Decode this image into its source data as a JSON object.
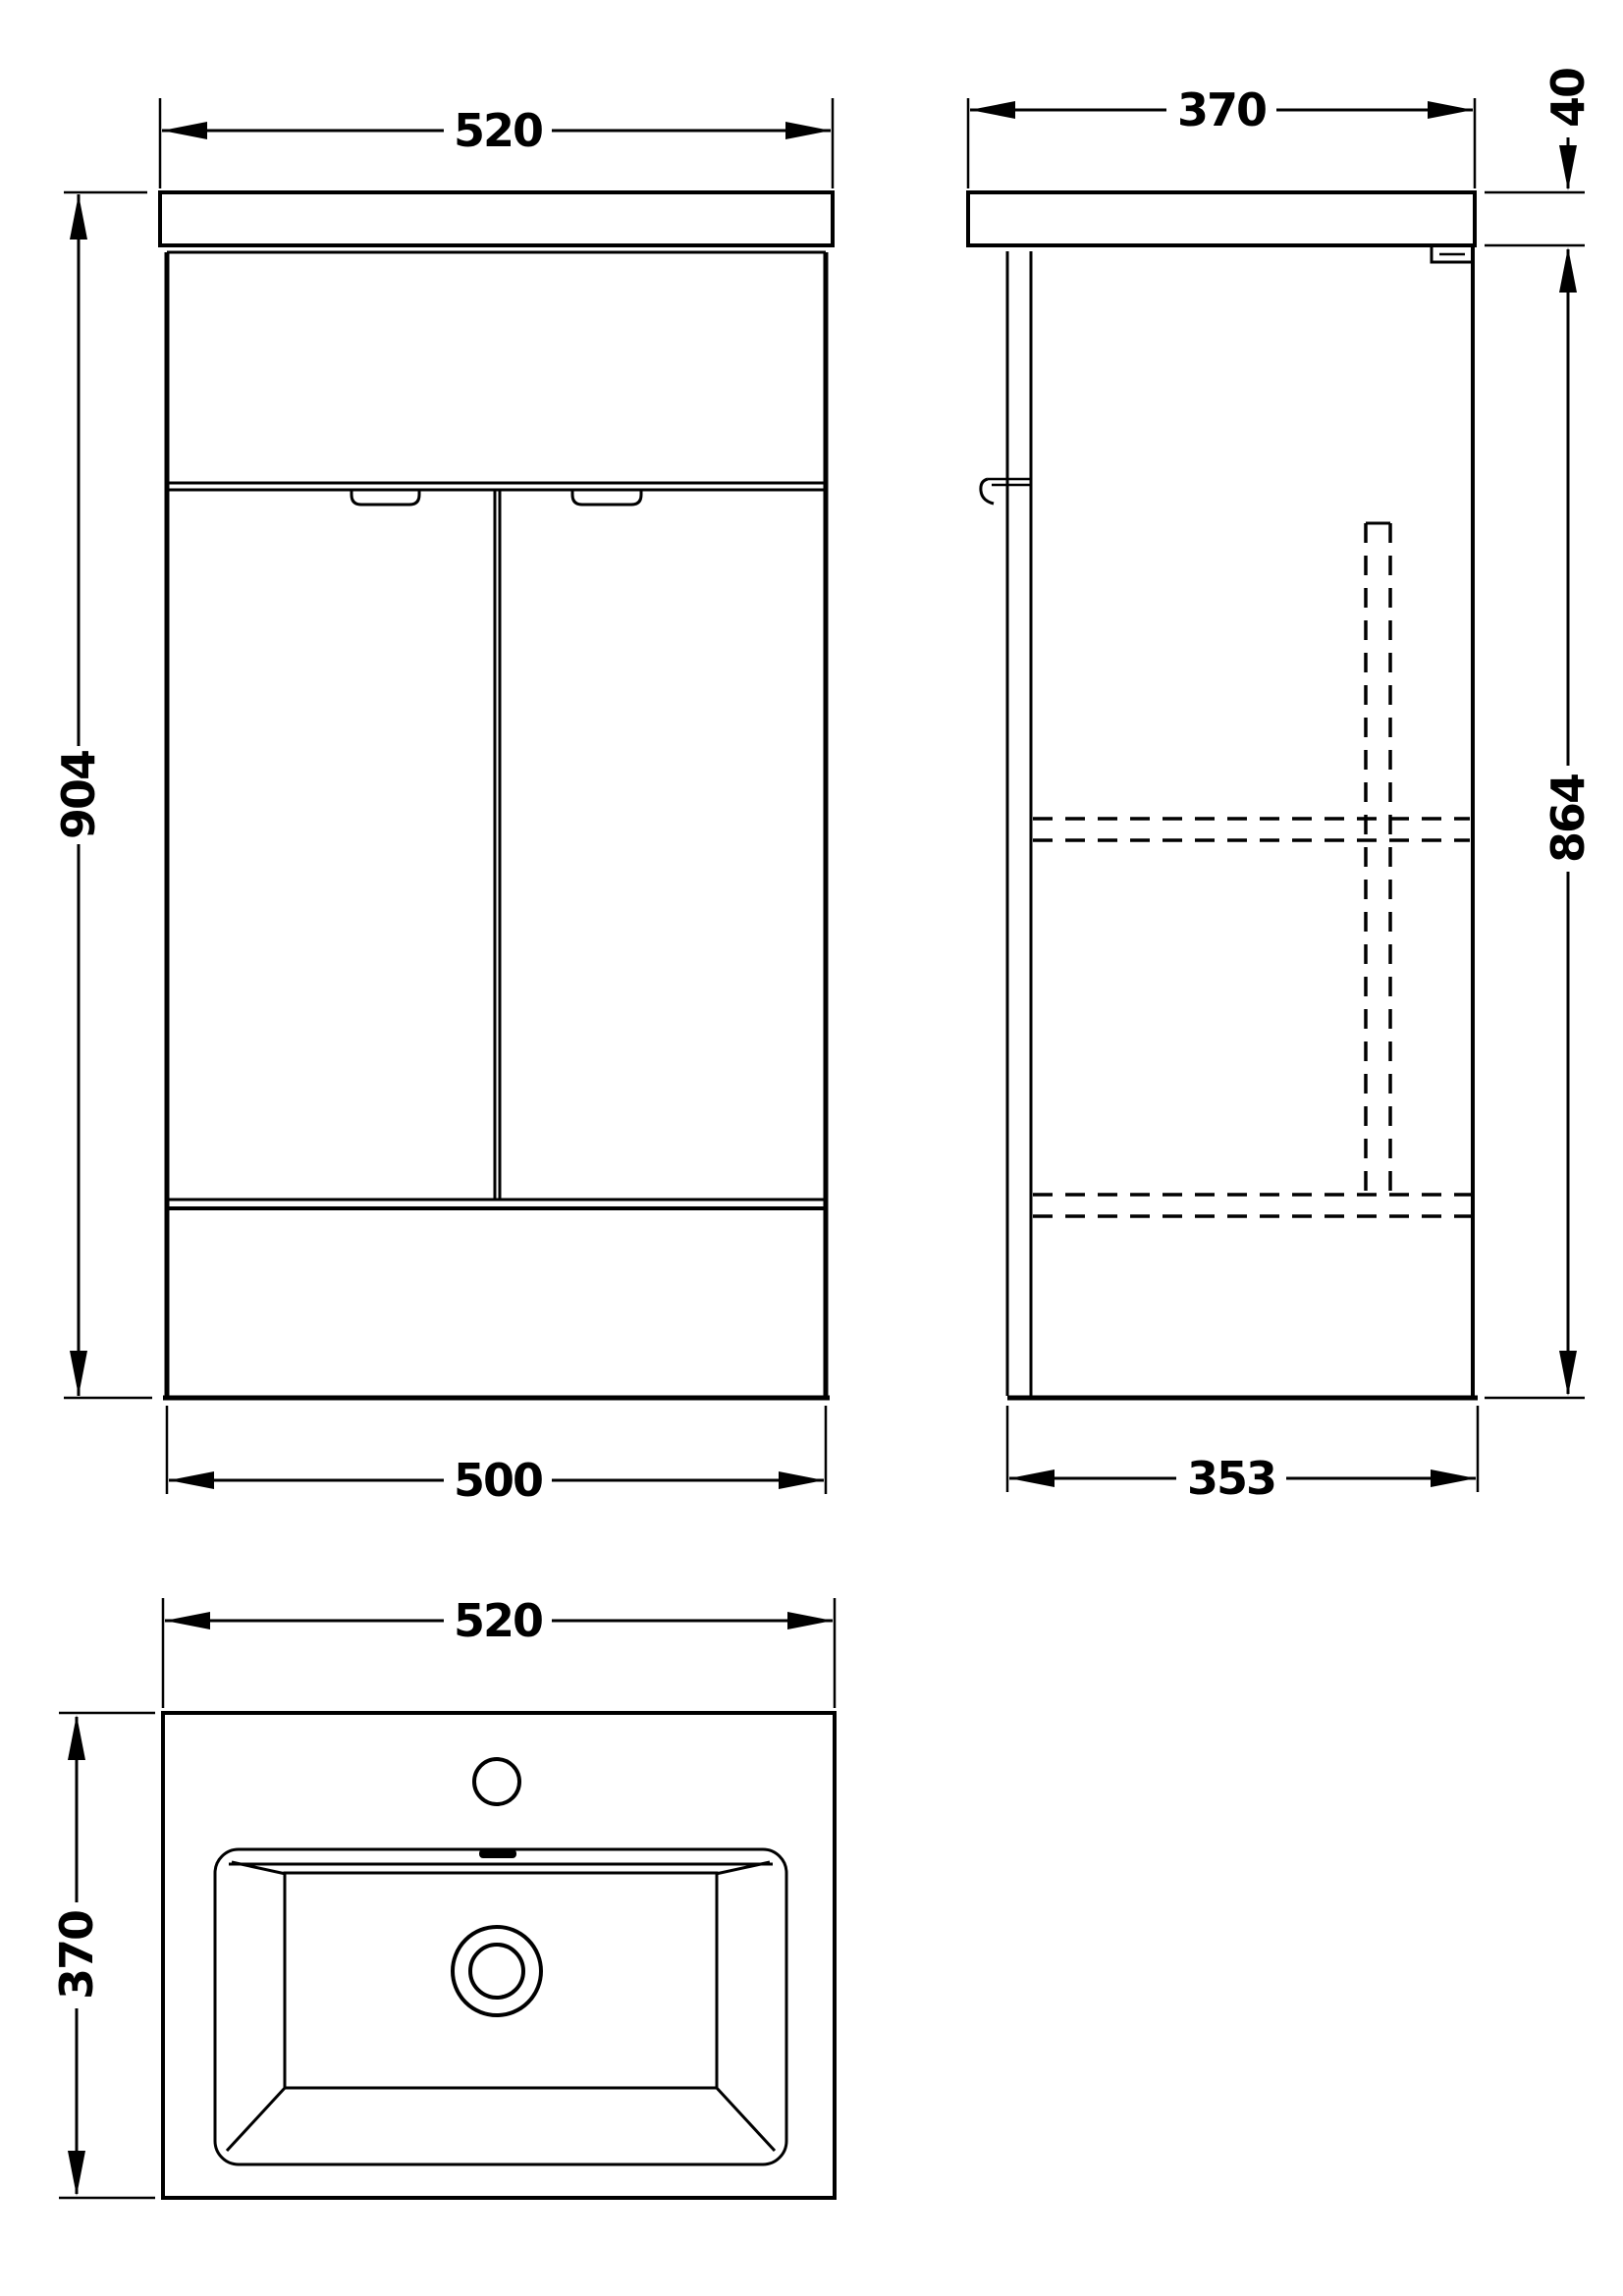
{
  "page": {
    "background_color": "#ffffff",
    "line_color": "#000000",
    "content_type": "technical dimension drawing of a floor-standing vanity basin unit"
  },
  "views": {
    "front": {
      "label": "front elevation",
      "dim_width_top": "520",
      "dim_height": "904",
      "dim_width_bottom": "500"
    },
    "side": {
      "label": "side elevation",
      "dim_depth_top": "370",
      "dim_counter_thickness": "40",
      "dim_cabinet_height": "864",
      "dim_depth_bottom": "353"
    },
    "plan": {
      "label": "basin plan",
      "dim_width": "520",
      "dim_depth": "370"
    }
  }
}
